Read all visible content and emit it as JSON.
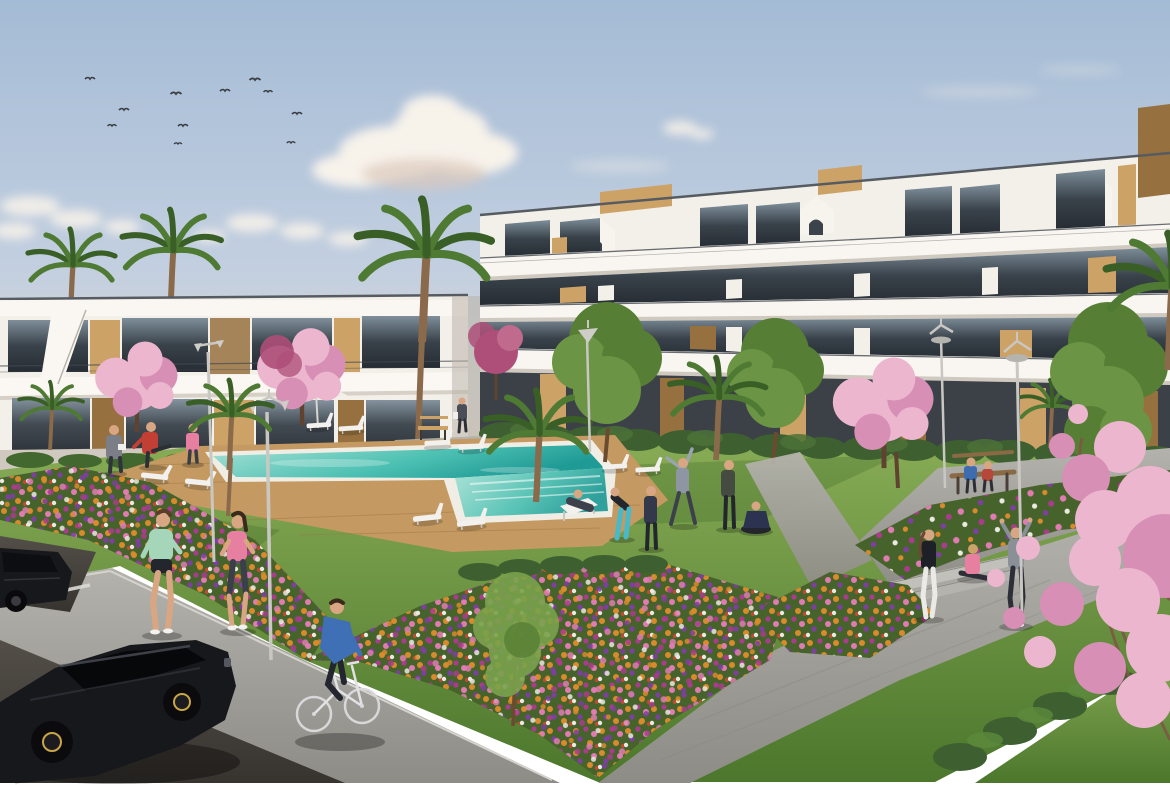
{
  "image": {
    "kind": "architectural-render",
    "description": "Aerial-eye view render of a white modern apartment complex with wooden accents, communal lawn, swimming pool with wooden deck, flower beds, palm and cherry-blossom trees, people exercising, a cyclist, and a parking area with two black cars under a blue sky with birds",
    "sky": {
      "birds_count": 11,
      "clouds": "scattered cumulus, large puff top-center, small puffs near left horizon"
    },
    "buildings": {
      "left_block": {
        "stories": 2,
        "style": "white flat-roof with dark glazing and timber panels"
      },
      "right_block": {
        "stories": 3,
        "style": "stepped white balconies, timber roof boxes, arched stair gables, ground-floor terraces behind hedges"
      }
    },
    "pool": {
      "shape": "long rectangle with attached near spa section",
      "deck": "timber",
      "loungers_count": 10,
      "deck_chairs": 1,
      "umbrellas": 1
    },
    "vegetation": {
      "palm_trees": 8,
      "blossom_trees": 5,
      "green_trees": 3,
      "flower_beds": 4,
      "hedges": "along building bases and path edge"
    },
    "people": [
      {
        "label": "man in grey by pool"
      },
      {
        "label": "man in red stretching"
      },
      {
        "label": "woman in pink by pool"
      },
      {
        "label": "woman bending, teal leggings"
      },
      {
        "label": "man standing dark"
      },
      {
        "label": "man stretching arm up"
      },
      {
        "label": "man standing olive"
      },
      {
        "label": "woman seated cross-legged"
      },
      {
        "label": "person on deck chair"
      },
      {
        "label": "woman standing white leggings"
      },
      {
        "label": "woman seated pink"
      },
      {
        "label": "person arms raised grey"
      },
      {
        "label": "couple on bench"
      },
      {
        "label": "jogger mint top"
      },
      {
        "label": "jogger pink top"
      },
      {
        "label": "cyclist in blue"
      },
      {
        "label": "walker near building"
      }
    ],
    "site": {
      "lamps_count": 5,
      "benches_count": 3,
      "cars_count": 2,
      "parking": "dark asphalt with white bay lines, bottom-left",
      "paths": "light concrete walkways with steps on the right"
    }
  },
  "palette": {
    "sky_top": "#a4bbd5",
    "sky_mid": "#c2cfe0",
    "sky_horizon": "#e4dacb",
    "cloud": "#f7f2ea",
    "cloud_shade": "#dcc9bb",
    "bird": "#3a3d42",
    "white_wall": "#f3f0ea",
    "wall_shade": "#ded8d0",
    "roof_line": "#565b61",
    "glass_hi": "#7e8e9a",
    "glass_lo": "#262c33",
    "wood_hi": "#cca267",
    "wood_lo": "#96713f",
    "grass_hi": "#87ab55",
    "grass_lo": "#4c772c",
    "hedge": "#3c5e2b",
    "hedge_hi": "#5d8a3c",
    "deck": "#c59a62",
    "deck_line": "#9c7442",
    "pool_hi": "#a9e2d6",
    "pool_mid": "#4cc0b2",
    "pool_lo": "#1f9a95",
    "coping": "#f0ede5",
    "path_hi": "#b4b2ac",
    "path_lo": "#8e8c86",
    "asphalt": "#534e48",
    "asphalt_dark": "#37342f",
    "stripe": "#e3e1da",
    "car_body": "#17181c",
    "rim_gold": "#c9a646",
    "trunk": "#6b4a2e",
    "palm": "#4e7a33",
    "palm_dark": "#3a5f26",
    "tree_green": "#567f35",
    "tree_green_hi": "#79a24c",
    "blossom": "#ecb6ce",
    "blossom_deep": "#d78fb5",
    "blossom_crimson": "#ad4f78",
    "flower_orange": "#d98a2c",
    "flower_pink": "#e07cb2",
    "flower_magenta": "#a93c8c",
    "flower_purple": "#7d3fa0",
    "flower_white": "#ece8e2",
    "flower_red": "#bf4b31",
    "skin": "#d9a684",
    "lamp": "#cfcdc8",
    "shirt_red": "#c23f35",
    "shirt_mint": "#a5d6ba",
    "shirt_pink": "#e77fa0",
    "shirt_blue": "#3f6fb5",
    "legs_teal": "#49b8c8",
    "navy": "#2b3350",
    "dark_grey": "#3a3f4a",
    "light_grey": "#8a8f98",
    "off_white": "#f0efec"
  }
}
